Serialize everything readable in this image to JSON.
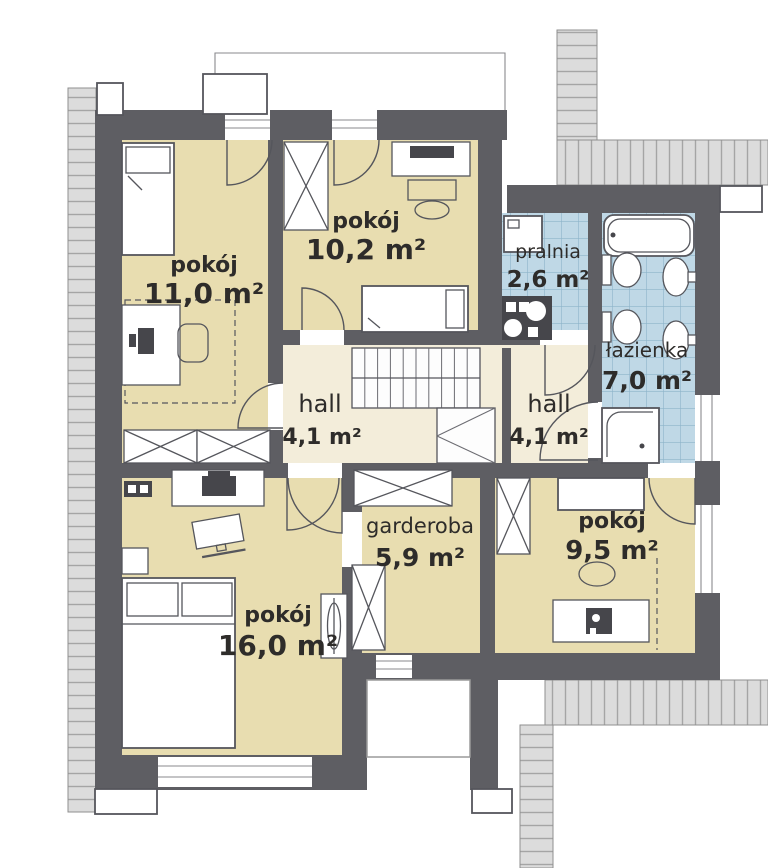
{
  "plan": {
    "type": "floor-plan",
    "rooms": [
      {
        "name": "pokój",
        "area": "11,0 m²"
      },
      {
        "name": "pokój",
        "area": "10,2 m²"
      },
      {
        "name": "pralnia",
        "area": "2,6 m²"
      },
      {
        "name": "łazienka",
        "area": "7,0 m²"
      },
      {
        "name": "hall",
        "area": "4,1 m²"
      },
      {
        "name": "hall",
        "area": "4,1 m²"
      },
      {
        "name": "garderoba",
        "area": "5,9 m²"
      },
      {
        "name": "pokój",
        "area": "9,5 m²"
      },
      {
        "name": "pokój",
        "area": "16,0 m²"
      }
    ],
    "colors": {
      "wall": "#5e5e63",
      "room_fill": "#e8ddb0",
      "hall_fill": "#f3edda",
      "tile_fill": "#bfd8e6",
      "tile_line": "#8db4ca",
      "roof_fill": "#dcdcdc",
      "roof_line": "#a5a5a5",
      "outline": "#55565c",
      "appliance_dark": "#46464b",
      "label_text": "#2e2c2a"
    }
  }
}
